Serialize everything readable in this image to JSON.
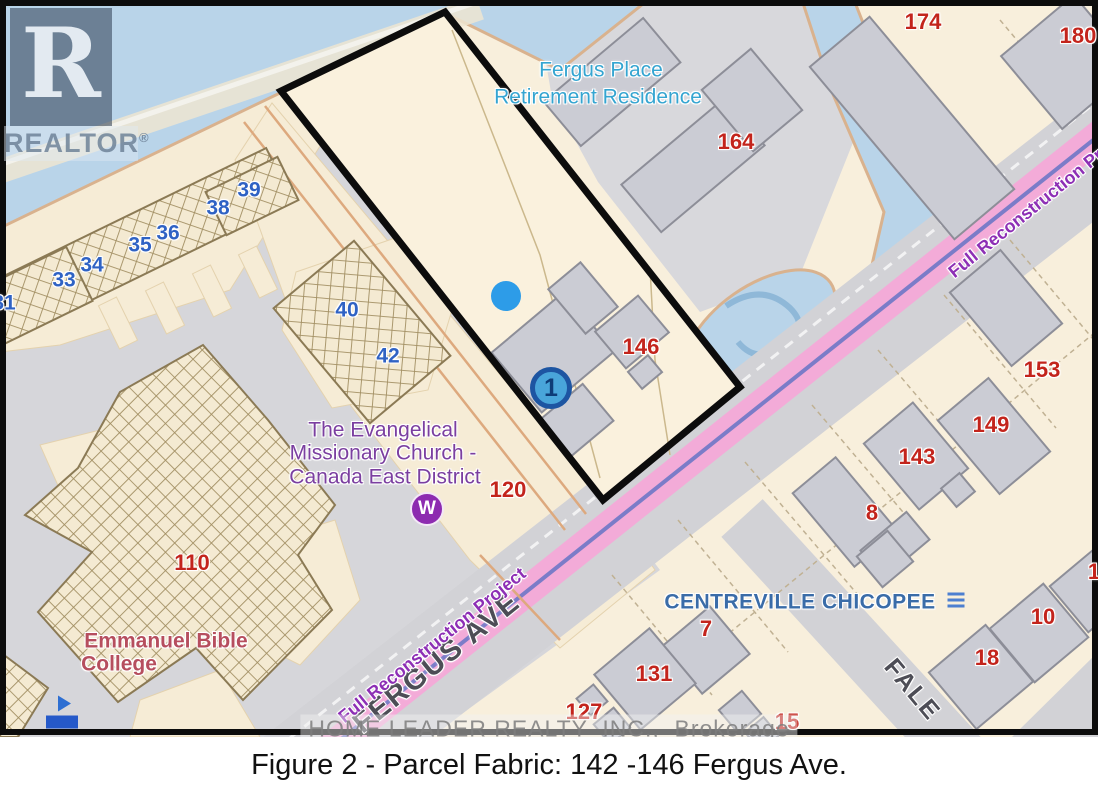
{
  "figure": {
    "caption": "Figure 2 - Parcel Fabric: 142 -146 Fergus Ave.",
    "watermark": "HOME LEADER REALTY  INC.,  Brokerage"
  },
  "logo": {
    "word": "REALTOR",
    "registered": "®",
    "letter": "R"
  },
  "colors": {
    "water": "#b9d4e9",
    "land": "#f8efdc",
    "lot_gray": "#d6d6da",
    "building_gray": "#cbccd4",
    "road_pink": "#f4a9d8",
    "road_centerline": "#7b7cc8",
    "parcel_outline": "#0c0c0c",
    "address_red": "#c3241c",
    "unit_blue": "#2f62c4",
    "teal": "#35a5d1",
    "church_purple": "#7b3fa0",
    "college_red": "#b64e5e",
    "neighbourhood_blue": "#3a6ca8",
    "project_purple": "#8d2fb5",
    "street_gray": "#4d4d56"
  },
  "labels": {
    "addresses": [
      {
        "text": "174",
        "x": 923,
        "y": 22
      },
      {
        "text": "180",
        "x": 1078,
        "y": 36
      },
      {
        "text": "164",
        "x": 736,
        "y": 142
      },
      {
        "text": "146",
        "x": 641,
        "y": 347
      },
      {
        "text": "153",
        "x": 1042,
        "y": 370
      },
      {
        "text": "149",
        "x": 991,
        "y": 425
      },
      {
        "text": "143",
        "x": 917,
        "y": 457
      },
      {
        "text": "8",
        "x": 872,
        "y": 513
      },
      {
        "text": "110",
        "x": 192,
        "y": 563
      },
      {
        "text": "120",
        "x": 508,
        "y": 490
      },
      {
        "text": "7",
        "x": 706,
        "y": 629
      },
      {
        "text": "131",
        "x": 654,
        "y": 674
      },
      {
        "text": "127",
        "x": 584,
        "y": 712
      },
      {
        "text": "15",
        "x": 787,
        "y": 722
      },
      {
        "text": "18",
        "x": 987,
        "y": 658
      },
      {
        "text": "10",
        "x": 1043,
        "y": 617
      },
      {
        "text": "1",
        "x": 1094,
        "y": 572
      }
    ],
    "units": [
      {
        "text": "31",
        "x": 4,
        "y": 303
      },
      {
        "text": "33",
        "x": 64,
        "y": 280
      },
      {
        "text": "34",
        "x": 92,
        "y": 265
      },
      {
        "text": "35",
        "x": 140,
        "y": 245
      },
      {
        "text": "36",
        "x": 168,
        "y": 233
      },
      {
        "text": "38",
        "x": 218,
        "y": 208
      },
      {
        "text": "39",
        "x": 249,
        "y": 190
      },
      {
        "text": "40",
        "x": 347,
        "y": 310
      },
      {
        "text": "42",
        "x": 388,
        "y": 356
      }
    ],
    "places_teal": [
      {
        "text": "Fergus Place",
        "x": 601,
        "y": 70
      },
      {
        "text": "Retirement Residence",
        "x": 598,
        "y": 97
      }
    ],
    "church": [
      {
        "text": "The Evangelical",
        "x": 383,
        "y": 430
      },
      {
        "text": "Missionary Church -",
        "x": 383,
        "y": 453
      },
      {
        "text": "Canada East District",
        "x": 385,
        "y": 477
      }
    ],
    "college": [
      {
        "text": "Emmanuel Bible",
        "x": 166,
        "y": 641
      },
      {
        "text": "College",
        "x": 119,
        "y": 664
      }
    ],
    "neighbourhood": [
      {
        "text": "CENTREVILLE CHICOPEE",
        "x": 800,
        "y": 602
      }
    ],
    "streets": [
      {
        "text": "FERGUS AVE",
        "x": 437,
        "y": 663,
        "rot": -39,
        "size": 29
      },
      {
        "text": "FALE",
        "x": 912,
        "y": 690,
        "rot": 50,
        "size": 25
      }
    ],
    "project": [
      {
        "text": "Full Reconstruction Project",
        "x": 1042,
        "y": 200,
        "rot": -39
      },
      {
        "text": "Full Reconstruction Project",
        "x": 432,
        "y": 645,
        "rot": -39
      }
    ]
  },
  "markers": {
    "parcel_point": {
      "text": "1",
      "x": 551,
      "y": 388
    },
    "well": {
      "text": "W",
      "x": 427,
      "y": 509
    },
    "blue_dot": {
      "x": 506,
      "y": 296
    },
    "flag": {
      "x": 62,
      "y": 712
    },
    "list_icon": {
      "x": 956,
      "y": 600
    }
  }
}
